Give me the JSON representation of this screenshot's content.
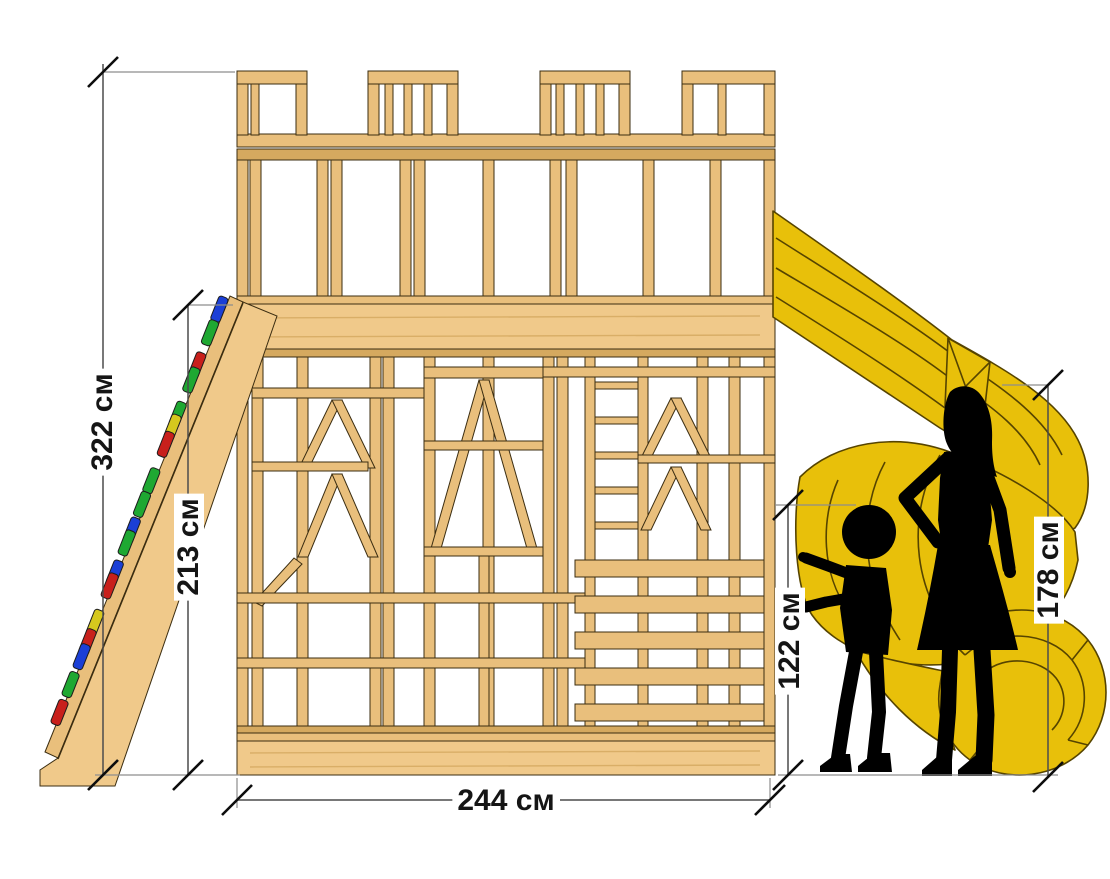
{
  "labels": {
    "height_total": "322 см",
    "height_platform": "213 см",
    "width_base": "244 см",
    "height_child": "122 см",
    "height_adult": "178 см"
  },
  "colors": {
    "wood": "#e9bf7c",
    "wood_light": "#f0c98a",
    "wood_dark": "#d5a95f",
    "outline": "#3b2d11",
    "slide_yellow": "#e8c00a",
    "slide_line": "#564400",
    "silhouette_black": "#000000",
    "dimension_line": "#4c4c4c",
    "hold_red": "#c8201c",
    "hold_green": "#1fa832",
    "hold_blue": "#1b3fd6",
    "hold_yellow": "#d6c81e"
  },
  "climbing_holds": {
    "colors": [
      "#1b3fd6",
      "#1fa832",
      "#c8201c",
      "#1fa832",
      "#1fa832",
      "#d6c81e",
      "#c8201c",
      "#1fa832",
      "#1fa832",
      "#1b3fd6",
      "#1fa832",
      "#1b3fd6",
      "#c8201c",
      "#d6c81e",
      "#c8201c",
      "#1b3fd6",
      "#1fa832",
      "#c8201c"
    ]
  }
}
